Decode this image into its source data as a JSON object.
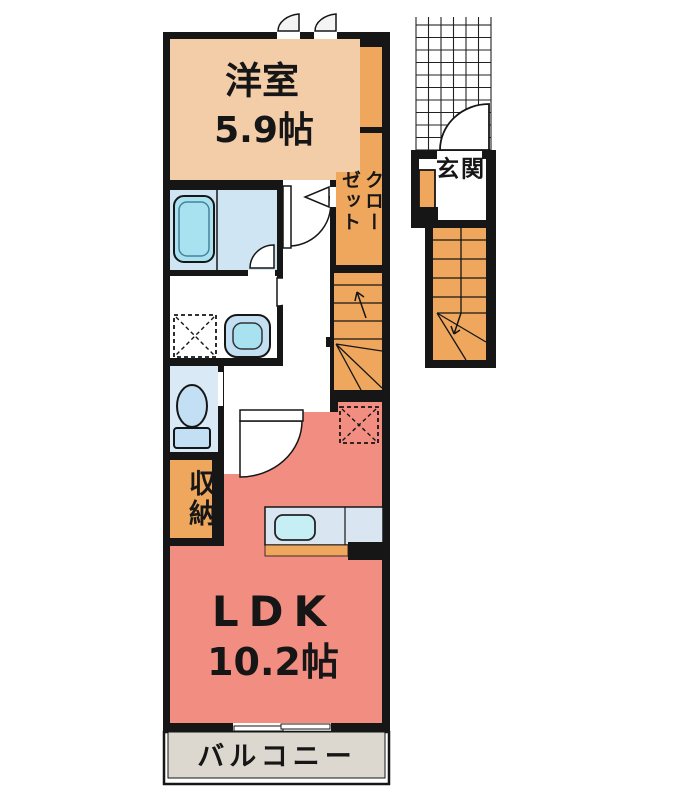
{
  "colors": {
    "wall": "#161616",
    "western": "#F3CCA8",
    "wood": "#EFA75D",
    "ldk": "#F28D81",
    "bath": "#CFE5F3",
    "toiletf": "#D9E9F6",
    "fixture": "#C2DFF4",
    "tub": "#A8E2F0",
    "sink": "#C6EFF5",
    "counter": "#D9E6F2",
    "balcony": "#DCD8CF"
  },
  "floorplan": {
    "rooms": {
      "western_room": {
        "label": "洋室",
        "size": "5.9帖"
      },
      "ldk": {
        "label": "LDK",
        "size": "10.2帖"
      },
      "closet": {
        "label": "クローゼット"
      },
      "storage": {
        "label": "収納"
      },
      "entrance": {
        "label": "玄関"
      },
      "balcony": {
        "label": "バルコニー"
      }
    }
  }
}
